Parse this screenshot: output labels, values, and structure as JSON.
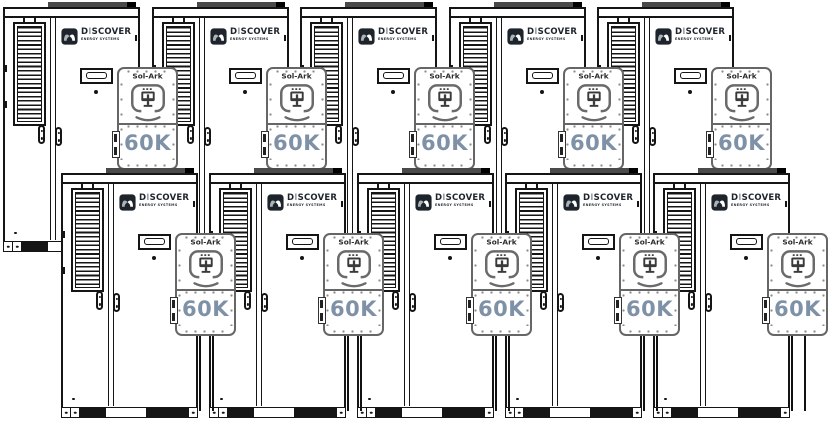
{
  "scene": {
    "width": 830,
    "height": 429,
    "background": "#ffffff"
  },
  "labels": {
    "brand": {
      "d": "D",
      "i": "I",
      "rest": "SCOVER",
      "subtitle": "ENERGY SYSTEMS"
    },
    "inverter": {
      "brand": "Sol-Ark",
      "model": "60K"
    }
  },
  "colors": {
    "line": "#151515",
    "inverter_line": "#666666",
    "model_text": "#7e91a6",
    "logo_dark": "#1d242c",
    "logo_i": "#9aa0a6",
    "roof_plate": "#4a4a4a"
  },
  "units": [
    {
      "row": "top",
      "x": 3,
      "y": 7
    },
    {
      "row": "top",
      "x": 152,
      "y": 7
    },
    {
      "row": "top",
      "x": 300,
      "y": 7
    },
    {
      "row": "top",
      "x": 449,
      "y": 7
    },
    {
      "row": "top",
      "x": 597,
      "y": 7
    },
    {
      "row": "bottom",
      "x": 61,
      "y": 173
    },
    {
      "row": "bottom",
      "x": 209,
      "y": 173
    },
    {
      "row": "bottom",
      "x": 357,
      "y": 173
    },
    {
      "row": "bottom",
      "x": 505,
      "y": 173
    },
    {
      "row": "bottom",
      "x": 653,
      "y": 173
    }
  ]
}
